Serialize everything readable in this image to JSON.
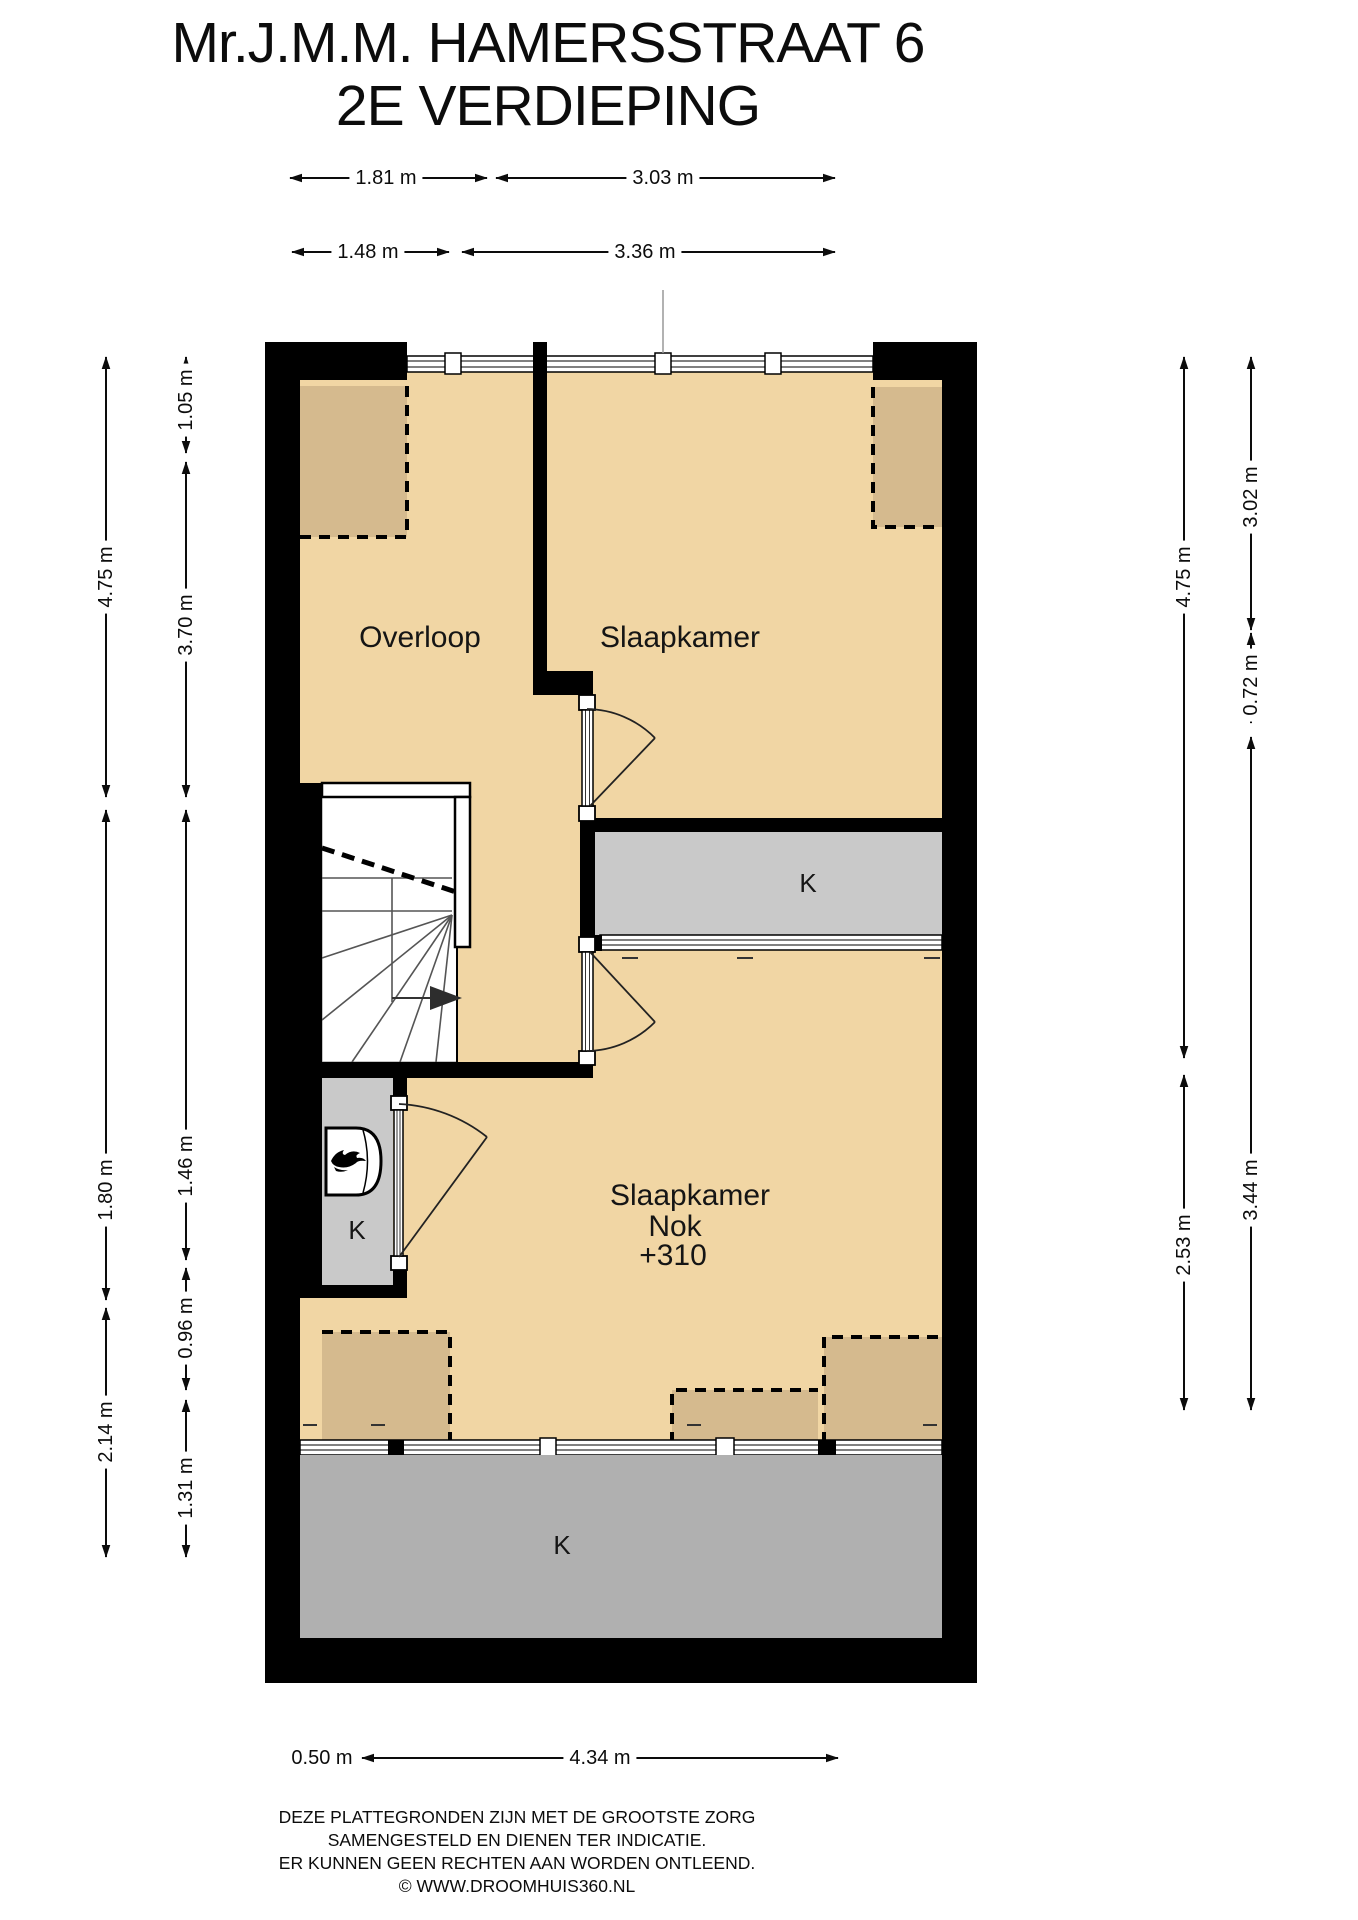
{
  "title": {
    "line1": "Mr.J.M.M. HAMERSSTRAAT 6",
    "line2": "2E VERDIEPING"
  },
  "rooms": {
    "overloop": "Overloop",
    "slaapkamer_top": "Slaapkamer",
    "k_mid": "K",
    "slaapkamer_bottom": {
      "line1": "Slaapkamer",
      "line2": "Nok",
      "line3": "+310"
    },
    "k_small": "K",
    "k_bottom": "K"
  },
  "dimensions": {
    "top_row1": [
      {
        "label": "1.81 m"
      },
      {
        "label": "3.03 m"
      }
    ],
    "top_row2": [
      {
        "label": "1.48 m"
      },
      {
        "label": "3.36 m"
      }
    ],
    "left_outer": [
      {
        "label": "4.75 m"
      },
      {
        "label": "1.80 m"
      },
      {
        "label": "2.14 m"
      }
    ],
    "left_inner": [
      {
        "label": "1.05 m"
      },
      {
        "label": "3.70 m"
      },
      {
        "label": "1.46 m"
      },
      {
        "label": "0.96 m"
      },
      {
        "label": "1.31 m"
      }
    ],
    "right_inner": [
      {
        "label": "4.75 m"
      },
      {
        "label": "2.53 m"
      }
    ],
    "right_outer": [
      {
        "label": "3.02 m"
      },
      {
        "label": "0.72 m"
      },
      {
        "label": "3.44 m"
      }
    ],
    "bottom": [
      {
        "label": "0.50 m"
      },
      {
        "label": "4.34 m"
      }
    ]
  },
  "footer": {
    "line1": "DEZE PLATTEGRONDEN ZIJN MET DE GROOTSTE ZORG",
    "line2": "SAMENGESTELD EN DIENEN TER INDICATIE.",
    "line3": "ER KUNNEN GEEN RECHTEN AAN WORDEN ONTLEEND.",
    "line4": "© WWW.DROOMHUIS360.NL"
  },
  "colors": {
    "wall": "#000000",
    "floor_tan": "#f1d6a4",
    "dormer_tan": "#d5ba8e",
    "gray_mid": "#c9c9c9",
    "gray_bottom": "#b0b0b0",
    "text": "#111111"
  },
  "icons": {
    "boiler": "flame-icon",
    "stairs_direction": "arrow-right-icon"
  }
}
